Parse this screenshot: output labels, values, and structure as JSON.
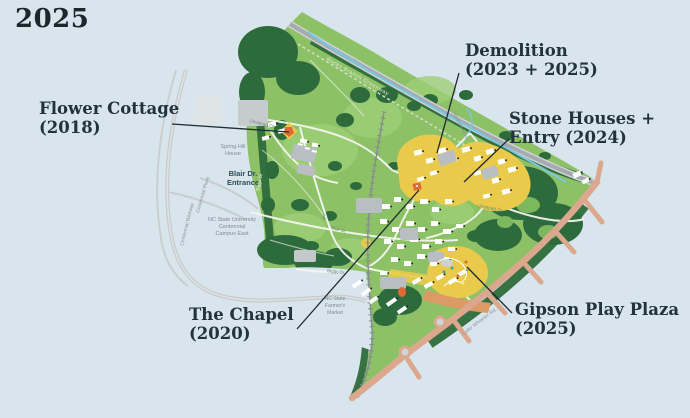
{
  "page": {
    "year_label": "2025"
  },
  "annotations": {
    "flower_cottage": {
      "line1": "Flower Cottage",
      "line2": "(2018)"
    },
    "demolition": {
      "line1": "Demolition",
      "line2": "(2023 + 2025)"
    },
    "stone_houses": {
      "line1": "Stone Houses +",
      "line2": "Entry (2024)"
    },
    "chapel": {
      "line1": "The Chapel",
      "line2": "(2020)"
    },
    "gipson": {
      "line1": "Gipson Play Plaza",
      "line2": "(2025)"
    }
  },
  "map_labels": {
    "rocky_branch_greenway": "Rocky Branch Greenway",
    "western_blvd": "Western Blvd",
    "umstead_dr_west": "Umstead Dr",
    "umstead_dr_east": "Umstead Dr",
    "blair_dr": "Blair Dr",
    "biggs_dr_south": "Biggs Dr",
    "biggs_dr_west": "Biggs Dr",
    "lake_wheeler_rd": "Lake Wheeler Rd.",
    "centennial_bikeway": "Centennial Bikeway",
    "centennial_pkwy": "Centennial Pkwy",
    "spring_hill_1": "Spring Hill",
    "spring_hill_2": "House",
    "blair_entrance_1": "Blair Dr.",
    "blair_entrance_2": "Entrance",
    "ncsu_1": "NC State University",
    "ncsu_2": "Centennial",
    "ncsu_3": "Campus East",
    "farmers_1": "NC State",
    "farmers_2": "Farmer's",
    "farmers_3": "Market",
    "healing_1": "Healing",
    "healing_2": "Transitions"
  },
  "colors": {
    "background_blue": "#d9e5ec",
    "park_green": "#8cc166",
    "forest_green": "#2e6b3c",
    "highlight_yellow": "#e9ca4b",
    "accent_orange": "#e06a35",
    "road_salmon": "#dba88e",
    "creek_blue": "#79c6e2",
    "label_dark": "#22333c"
  }
}
